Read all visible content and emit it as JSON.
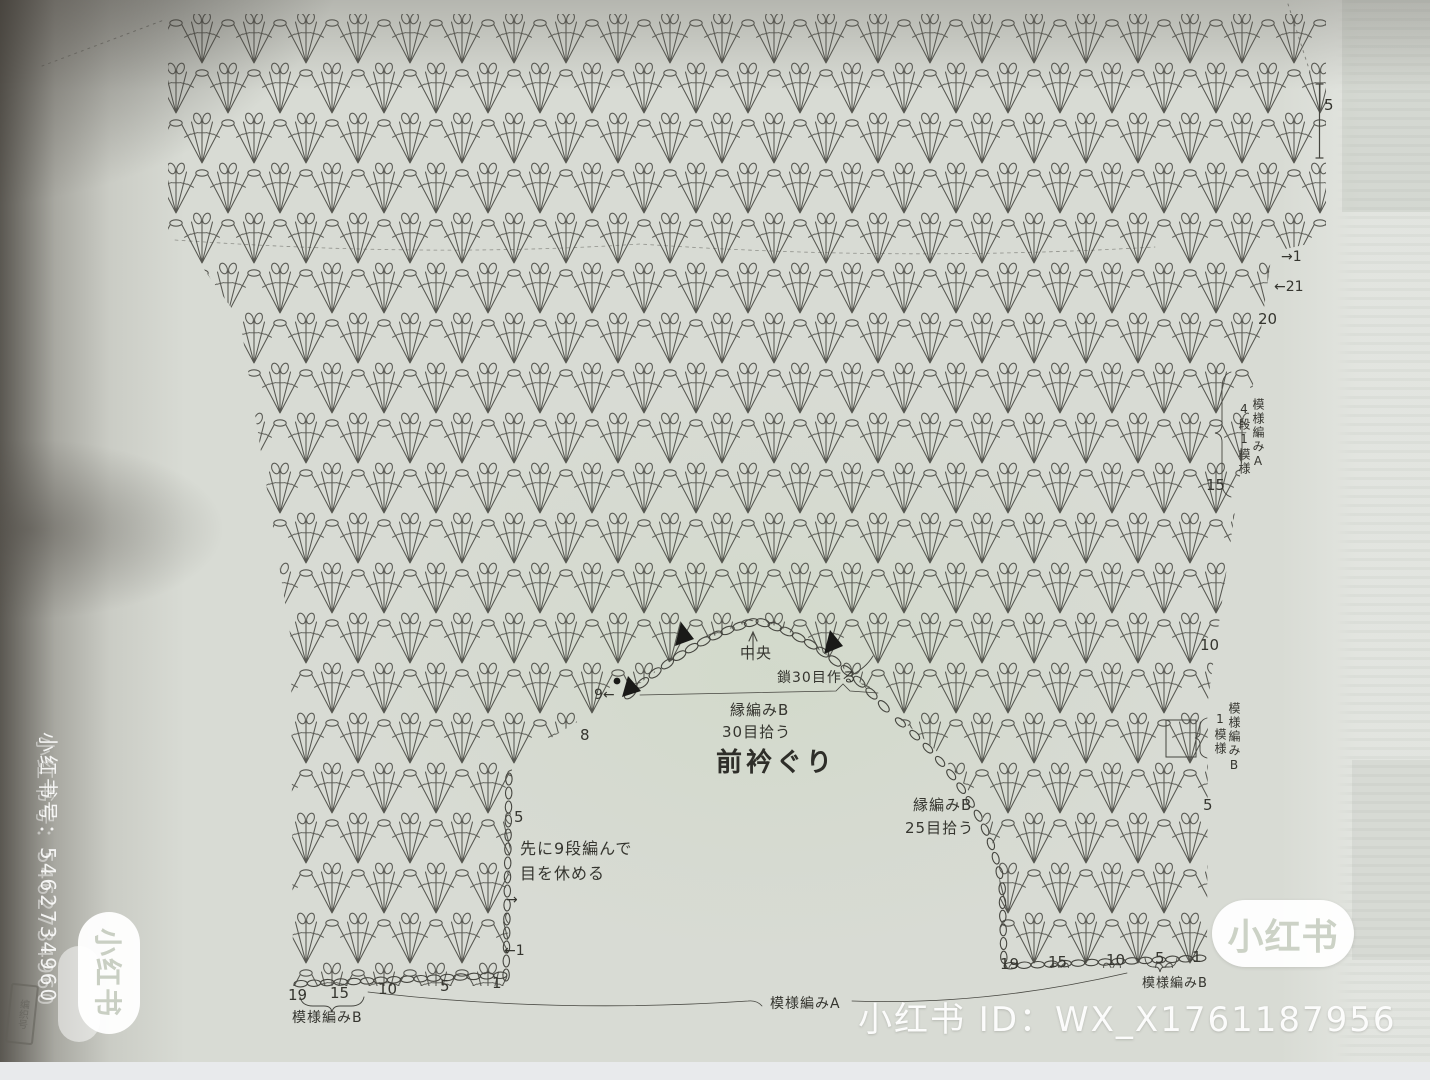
{
  "diagram_labels": {
    "center_marker": "中央",
    "chain_cast_on": "鎖30目作る",
    "neck_edge_pickup_top": [
      "縁編みB",
      "30目拾う"
    ],
    "front_neckline": "前衿ぐり",
    "neck_edge_pickup_right": [
      "縁編みB",
      "25目拾う"
    ],
    "hold_stitches_note": [
      "先に9段編んで",
      "目を休める"
    ],
    "pattern_a_bottom": "模様編みA",
    "pattern_b_bottom_left": "模様編みB",
    "pattern_b_bottom_right": "模様編みB",
    "pattern_a_right_col1": "模様編みA",
    "pattern_a_right_col2": "4段1模様",
    "pattern_b_right_col1": "模様編みB",
    "pattern_b_right_col2": "1模様"
  },
  "row_numbers": {
    "top_right_count": "5",
    "right_edge": [
      "→1",
      "←21",
      "20",
      "15",
      "10",
      "5"
    ],
    "left_inner": [
      "9←",
      "8",
      "5",
      "→",
      "←1"
    ],
    "bottom_left": [
      "19",
      "15",
      "10",
      "5",
      "1"
    ],
    "bottom_right": [
      "19",
      "15",
      "10",
      "5",
      "1"
    ]
  },
  "watermarks": {
    "id_line": "小红书 ID：WX_X1761187956",
    "side_account": "小红书号：5462734960",
    "badge_right": "小红书",
    "badge_left": "小红书",
    "corner_stamp": "编织号"
  }
}
